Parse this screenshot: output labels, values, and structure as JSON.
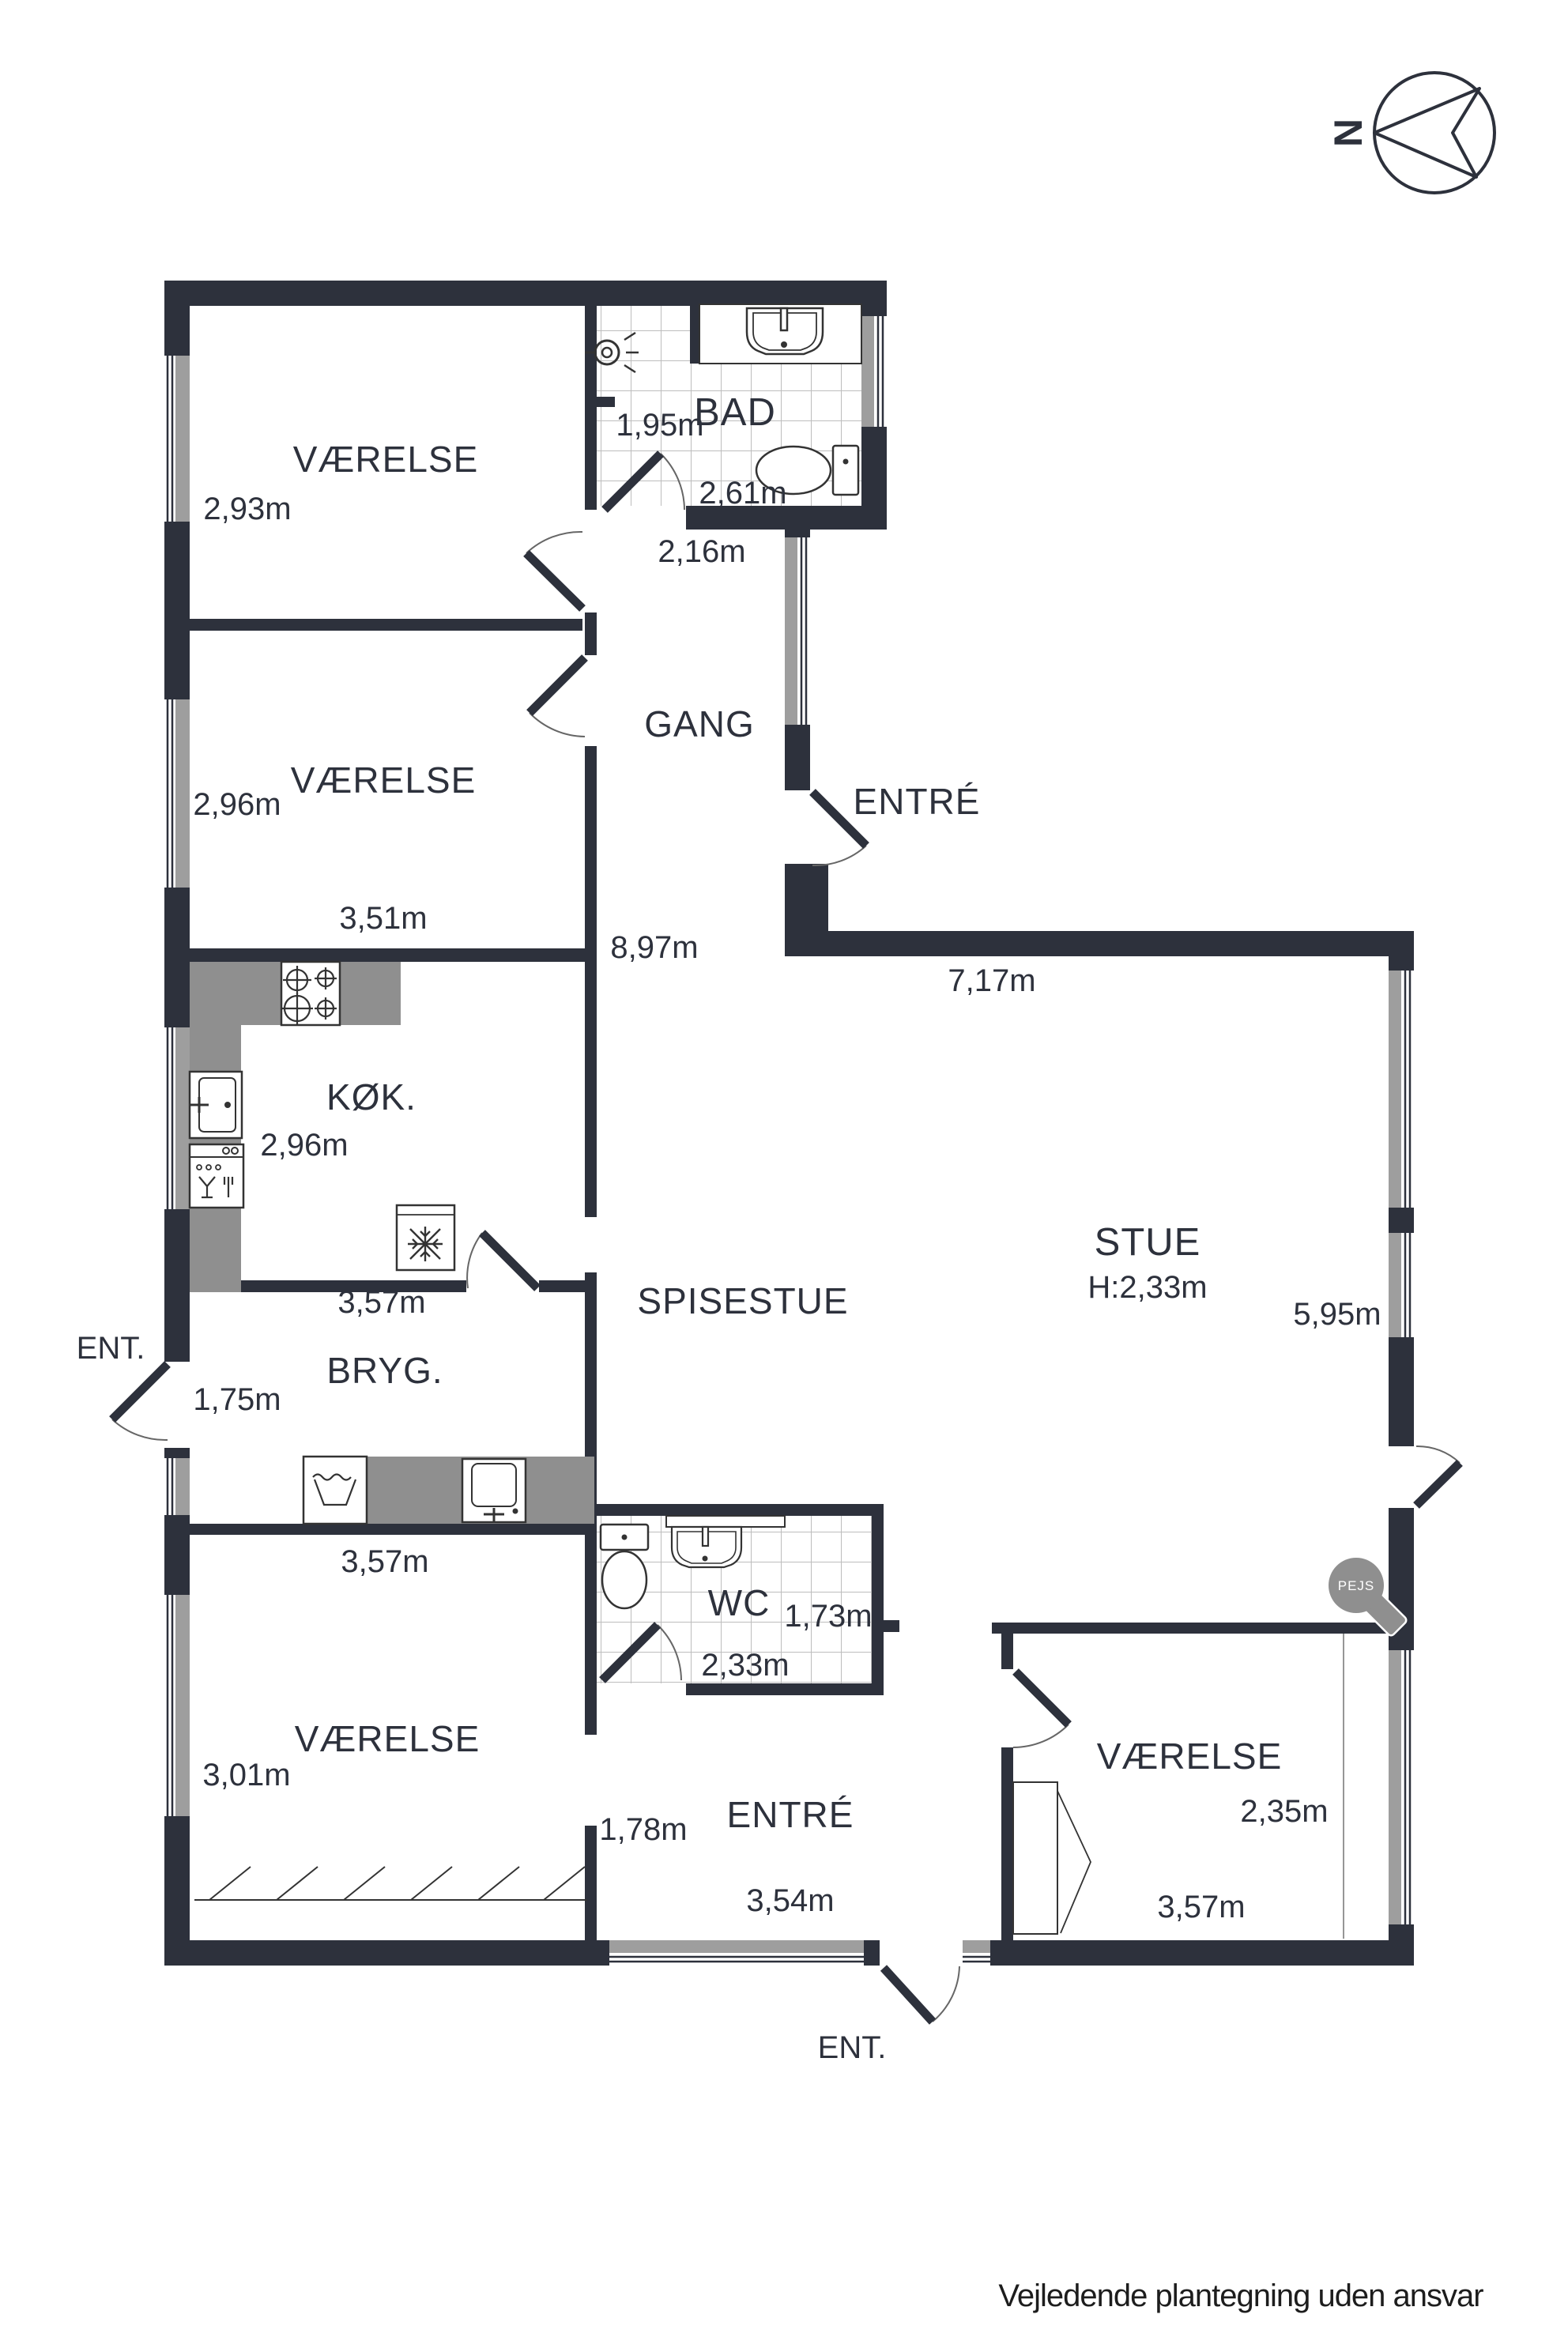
{
  "meta": {
    "north": "N",
    "disclaimer": "Vejledende plantegning uden ansvar"
  },
  "colors": {
    "wall": "#2d313c",
    "counter": "#8f8f8f",
    "window_glass": "#9e9e9e",
    "tile_line": "#bdbdbd",
    "text": "#2d313c"
  },
  "rooms": {
    "vaerelse_nw": {
      "label": "VÆRELSE",
      "depth": "2,93m"
    },
    "vaerelse_w": {
      "label": "VÆRELSE",
      "depth": "2,96m",
      "width": "3,51m"
    },
    "bad": {
      "label": "BAD",
      "d1": "1,95m",
      "d2": "2,61m",
      "d3": "2,16m"
    },
    "gang": {
      "label": "GANG"
    },
    "entre_front": {
      "label": "ENTRÉ"
    },
    "hall": {
      "depth": "8,97m"
    },
    "koek": {
      "label": "KØK.",
      "depth": "2,96m",
      "width": "3,57m"
    },
    "stue": {
      "label": "STUE",
      "ceiling": "H:2,33m",
      "width": "7,17m",
      "depth": "5,95m"
    },
    "spisestue": {
      "label": "SPISESTUE"
    },
    "bryg": {
      "label": "BRYG.",
      "d1": "1,75m",
      "width": "3,57m",
      "ent": "ENT."
    },
    "wc": {
      "label": "WC",
      "d1": "1,73m",
      "d2": "2,33m"
    },
    "vaerelse_sw": {
      "label": "VÆRELSE",
      "depth": "3,01m"
    },
    "entre_s": {
      "label": "ENTRÉ",
      "d1": "1,78m",
      "width": "3,54m",
      "ent": "ENT."
    },
    "vaerelse_se": {
      "label": "VÆRELSE",
      "depth": "2,35m",
      "width": "3,57m"
    }
  },
  "fixtures": {
    "fireplace": "PEJS"
  }
}
